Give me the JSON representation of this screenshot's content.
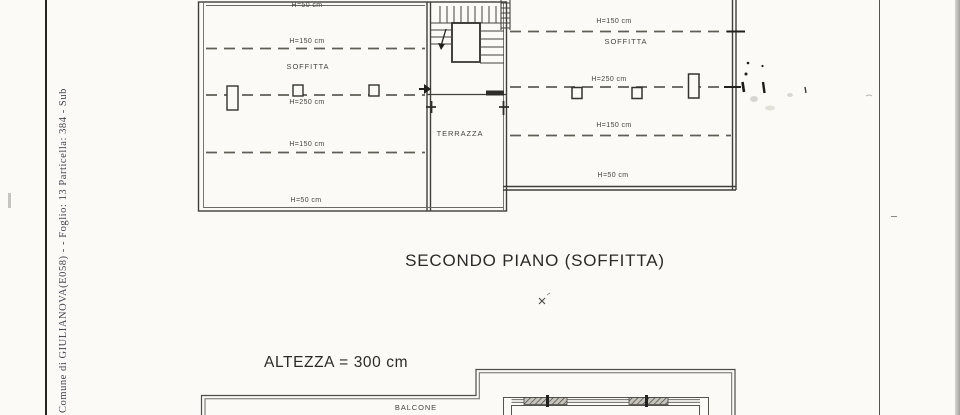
{
  "margin": {
    "registry_text": "Comune di GIULIANOVA(E058) - - Foglio: 13 Particella: 384 - Sub"
  },
  "floor_plan": {
    "title": "SECONDO PIANO (SOFFITTA)",
    "height_note": "ALTEZZA = 300 cm",
    "rooms": {
      "soffitta_left": "SOFFITTA",
      "soffitta_right": "SOFFITTA",
      "terrazza": "TERRAZZA",
      "balcone": "BALCONE"
    },
    "left_heights": {
      "top": "H=50 cm",
      "upper": "H=150 cm",
      "middle": "H=250 cm",
      "lower": "H=150 cm",
      "bottom": "H=50 cm"
    },
    "right_heights": {
      "upper": "H=150 cm",
      "middle": "H=250 cm",
      "lower": "H=150 cm",
      "bottom": "H=50 cm"
    }
  }
}
